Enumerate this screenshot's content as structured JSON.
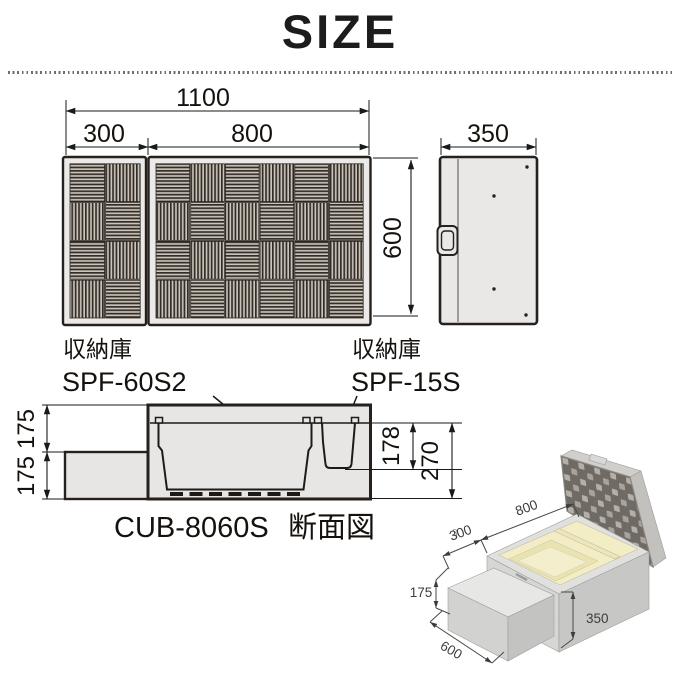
{
  "page": {
    "title": "SIZE"
  },
  "plan_view": {
    "total_width": "1100",
    "left_section_width": "300",
    "right_section_width": "800",
    "height": "600"
  },
  "side_view": {
    "width": "350"
  },
  "unit_labels": {
    "left": {
      "type": "収納庫",
      "model": "SPF-60S2"
    },
    "right": {
      "type": "収納庫",
      "model": "SPF-15S"
    }
  },
  "cross_section": {
    "upper_step_height": "175",
    "lower_step_height": "175",
    "inner_box_depth": "178",
    "total_depth": "270",
    "model": "CUB-8060S",
    "caption": "断面図",
    "page_mark": "3"
  },
  "illustration": {
    "top_edge": "800",
    "left_edge": "300",
    "step_height": "175",
    "box_height": "350",
    "depth": "600"
  },
  "colors": {
    "line": "#1f1a16",
    "panel_bg": "#eceae8",
    "stripe_dark": "#332d27",
    "stripe_light": "#c9c3ba",
    "interior_cream": "#f2edc4",
    "lid_dark": "#6f6a63"
  }
}
